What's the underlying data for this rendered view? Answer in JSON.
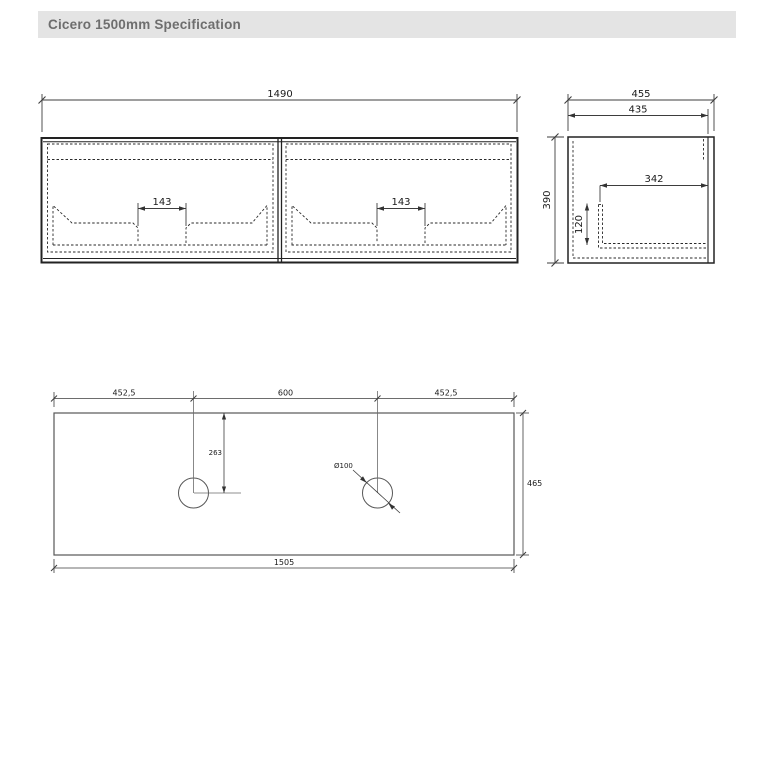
{
  "header": {
    "title": "Cicero 1500mm Specification"
  },
  "views": {
    "front": {
      "overall_width": "1490",
      "handle_cutout_left": "143",
      "handle_cutout_right": "143"
    },
    "side": {
      "overall_depth": "455",
      "carcass_depth": "435",
      "height": "390",
      "internal_depth": "342",
      "internal_height": "120"
    },
    "top": {
      "hole_offset_left": "452,5",
      "hole_centres": "600",
      "hole_offset_right": "452,5",
      "hole_setback": "263",
      "hole_diameter": "Ø100",
      "worktop_depth": "465",
      "worktop_width": "1505"
    }
  },
  "colors": {
    "background": "#ffffff",
    "header_bg": "#e4e4e4",
    "header_text": "#6e6e6e",
    "line": "#222222",
    "line_light": "#575757",
    "dim": "#3d3d3d"
  }
}
